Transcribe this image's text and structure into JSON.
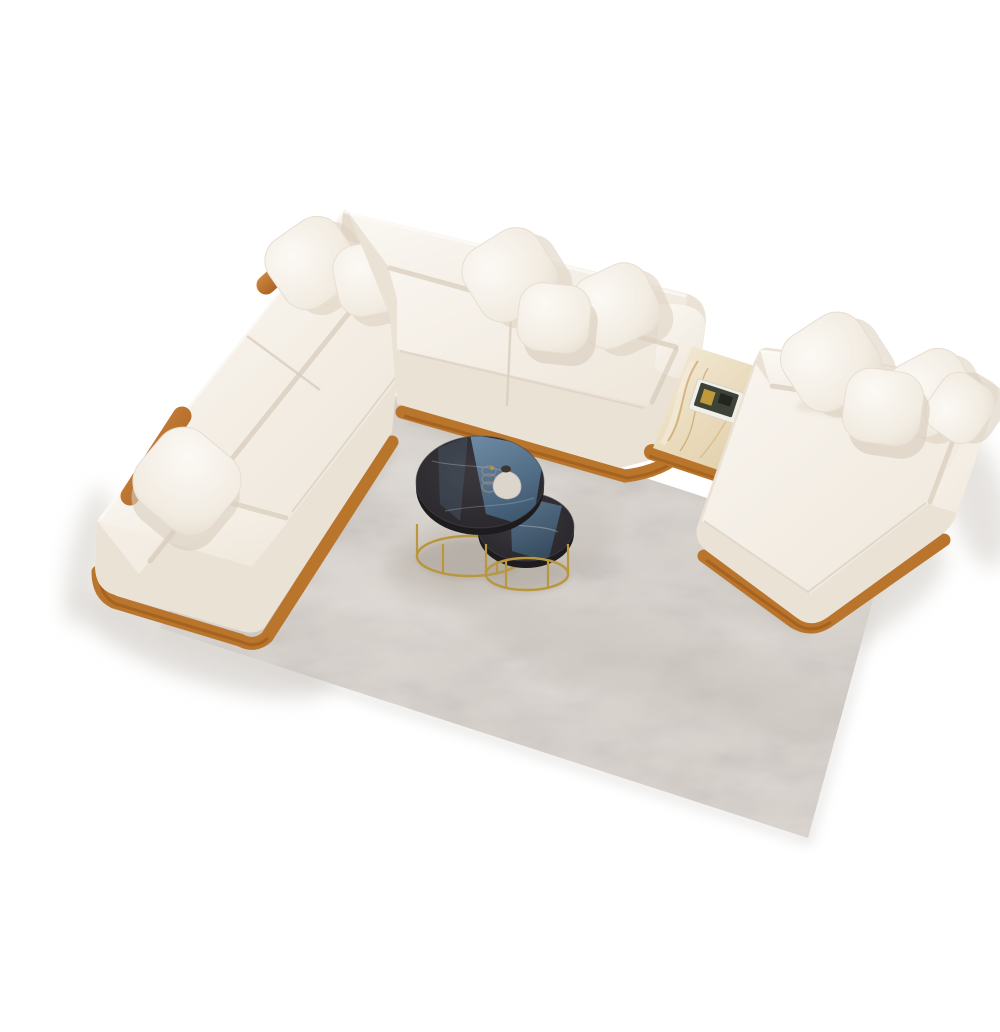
{
  "scene": {
    "description": "Top-down 3D render of a cream modular sectional sofa set: an L-shaped sofa with wooden bolster headrests, a separate chaise module joined by a beige marble side table on a wooden platform, two black-marble nesting coffee tables with brass bases and a small vase, all arranged on a light gray rug over a white floor.",
    "background_color": "#ffffff"
  },
  "colors": {
    "rug_base": "#d9d3cd",
    "fabric_side": "#ebe2d6",
    "fabric_top": "#f6f1ea",
    "wood": "#b9752c",
    "brass": "#b8973f",
    "table_edge": "#1d1b1e",
    "reflection_blue": "#5d82a4",
    "vase": "#dcd5cb",
    "book_pages": "#f2efe8",
    "book_cover": "#3e4338",
    "book_accent": "#c09a3a",
    "marble_vein": "#c29a55",
    "floor_shadow": "#d6d2cd"
  },
  "objects": [
    {
      "name": "area-rug",
      "description": "light gray textured rug laid diagonally"
    },
    {
      "name": "sofa-left-wing",
      "description": "left sofa wing with end armrest on wooden plinth"
    },
    {
      "name": "sofa-top-section",
      "description": "upper sofa section with rounded right armrest"
    },
    {
      "name": "chaise-section",
      "description": "wide chaise / daybed module with corner backrest"
    },
    {
      "name": "marble-side-table",
      "description": "beige veined marble tabletop inset in wooden platform"
    },
    {
      "name": "book-decor",
      "description": "book with dark cover lying on the marble table"
    },
    {
      "name": "wooden-bolster",
      "description": "cylindrical wood headrest rail on sofa back"
    },
    {
      "name": "throw-pillow",
      "description": "cream boucle cushions (9)"
    },
    {
      "name": "large-coffee-table",
      "description": "black marble top, brass wire base, nesting"
    },
    {
      "name": "small-coffee-table",
      "description": "smaller nesting table tucked under the large one"
    },
    {
      "name": "decor-vase",
      "description": "small white teardrop vase"
    },
    {
      "name": "decor-wire-ornament",
      "description": "small wire/glass ornament"
    }
  ]
}
